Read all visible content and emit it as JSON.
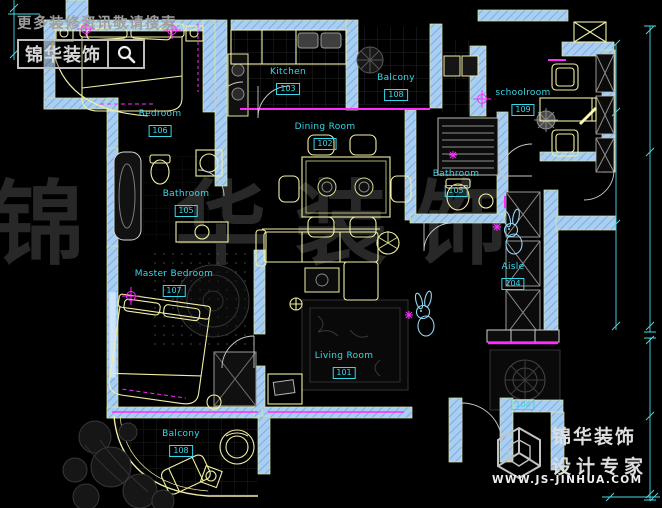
{
  "watermarks": {
    "top_left": {
      "tagline": "更多装修资讯敬请搜索",
      "brand": "锦华装饰"
    },
    "center": {
      "chars": [
        "锦",
        "华",
        "装",
        "饰"
      ]
    },
    "bottom_right": {
      "brand": "锦华装饰",
      "subtitle": "设计专家",
      "url": "WWW.JS-JINHUA.COM"
    }
  },
  "rooms": [
    {
      "name": "Bedroom",
      "number": "106"
    },
    {
      "name": "Kitchen",
      "number": "103"
    },
    {
      "name": "Balcony",
      "number": "108"
    },
    {
      "name": "schoolroom",
      "number": "109"
    },
    {
      "name": "Dining Room",
      "number": "102"
    },
    {
      "name": "Bathroom",
      "number": "105"
    },
    {
      "name": "Bathroom",
      "number": "105"
    },
    {
      "name": "Master Bedroom",
      "number": "107"
    },
    {
      "name": "Living Room",
      "number": "101"
    },
    {
      "name": "Aisle",
      "number": "104"
    },
    {
      "name": "Balcony",
      "number": "108"
    },
    {
      "name": "",
      "number": "104"
    }
  ],
  "colors": {
    "background": "#000000",
    "wall": "#a9cef2",
    "furniture_line": "#f2efa2",
    "accent": "#ff2bff",
    "room_label": "#38d8ea",
    "dimension": "#49dce6",
    "watermark_gray": "#9f9f9f"
  },
  "icons": [
    "search-icon",
    "cube-logo-icon",
    "rabbit-decal-icon",
    "crosshair-icon"
  ]
}
